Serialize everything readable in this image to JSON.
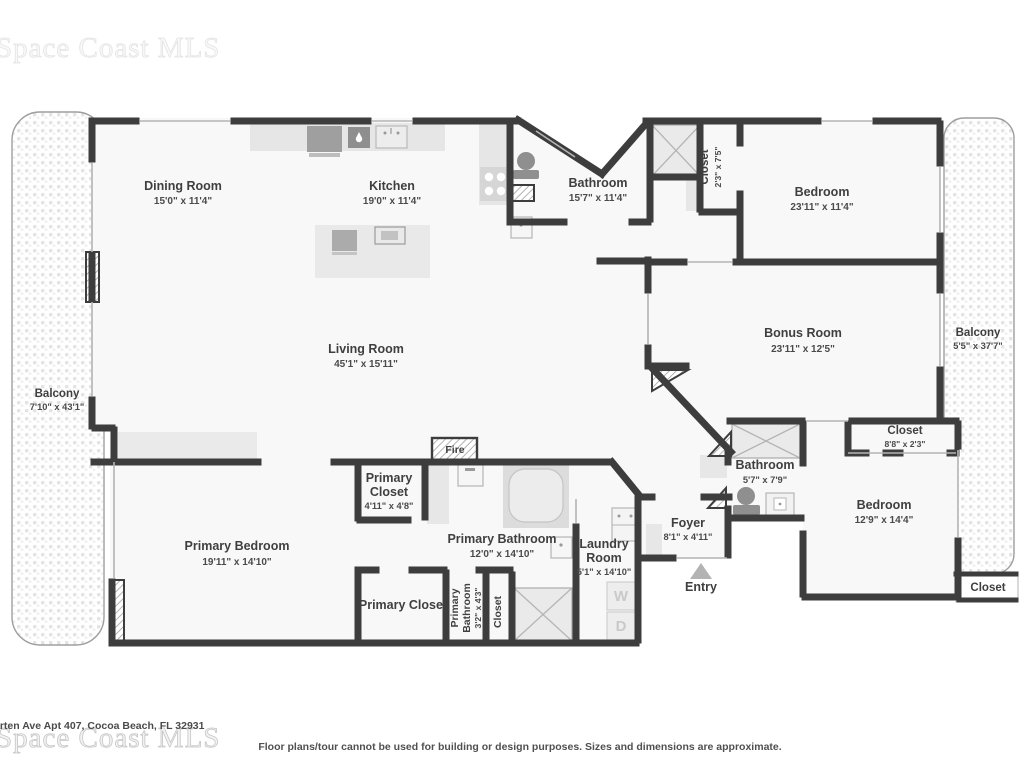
{
  "watermarks": {
    "top_left": "Space Coast MLS",
    "bottom_left": "Space Coast MLS"
  },
  "footer": {
    "address": "arten Ave Apt 407, Cocoa Beach, FL 32931",
    "disclaimer": "Floor plans/tour cannot be used for building or design purposes. Sizes and dimensions are approximate."
  },
  "colors": {
    "wall": "#3d3d3d",
    "label_text": "#3f3f3f",
    "dims_text": "#4a4a4a",
    "fixture_gray": "#8f8f8f",
    "floor_fill": "#f8f8f8",
    "balcony_dot": "#e4e4e4",
    "watermark": "#cccccc"
  },
  "rooms": {
    "dining_room": {
      "name": "Dining Room",
      "dims": "15'0\" x 11'4\""
    },
    "kitchen": {
      "name": "Kitchen",
      "dims": "19'0\" x 11'4\""
    },
    "bathroom_top": {
      "name": "Bathroom",
      "dims": "15'7\" x 11'4\""
    },
    "closet_hall": {
      "name": "Closet",
      "dims": "2'3\" x 7'5\""
    },
    "bedroom_top": {
      "name": "Bedroom",
      "dims": "23'11\" x 11'4\""
    },
    "living_room": {
      "name": "Living Room",
      "dims": "45'1\" x 15'11\""
    },
    "bonus_room": {
      "name": "Bonus Room",
      "dims": "23'11\" x 12'5\""
    },
    "balcony_right": {
      "name": "Balcony",
      "dims": "5'5\" x 37'7\""
    },
    "balcony_left": {
      "name": "Balcony",
      "dims": "7'10\" x 43'1\""
    },
    "primary_bedroom": {
      "name": "Primary Bedroom",
      "dims": "19'11\" x 14'10\""
    },
    "primary_closet_small": {
      "name1": "Primary",
      "name2": "Closet",
      "dims": "4'11\" x 4'8\""
    },
    "primary_bathroom": {
      "name": "Primary Bathroom",
      "dims": "12'0\" x 14'10\""
    },
    "primary_closet_large": {
      "name": "Primary Closet"
    },
    "primary_bathroom_small": {
      "name1": "Primary",
      "name2": "Bathroom",
      "dims": "3'2\" x 4'3\""
    },
    "closet_inner": {
      "name": "Closet"
    },
    "laundry_room": {
      "name1": "Laundry",
      "name2": "Room",
      "dims": "5'1\" x 14'10\""
    },
    "foyer": {
      "name": "Foyer",
      "dims": "8'1\" x 4'11\""
    },
    "bathroom_right": {
      "name": "Bathroom",
      "dims": "5'7\" x 7'9\""
    },
    "closet_bedroom": {
      "name": "Closet",
      "dims": "8'8\" x 2'3\""
    },
    "bedroom_right": {
      "name": "Bedroom",
      "dims": "12'9\" x 14'4\""
    },
    "closet_exterior": {
      "name": "Closet"
    }
  },
  "markers": {
    "fire": "Fire",
    "entry": "Entry",
    "washer": "W",
    "dryer": "D"
  }
}
